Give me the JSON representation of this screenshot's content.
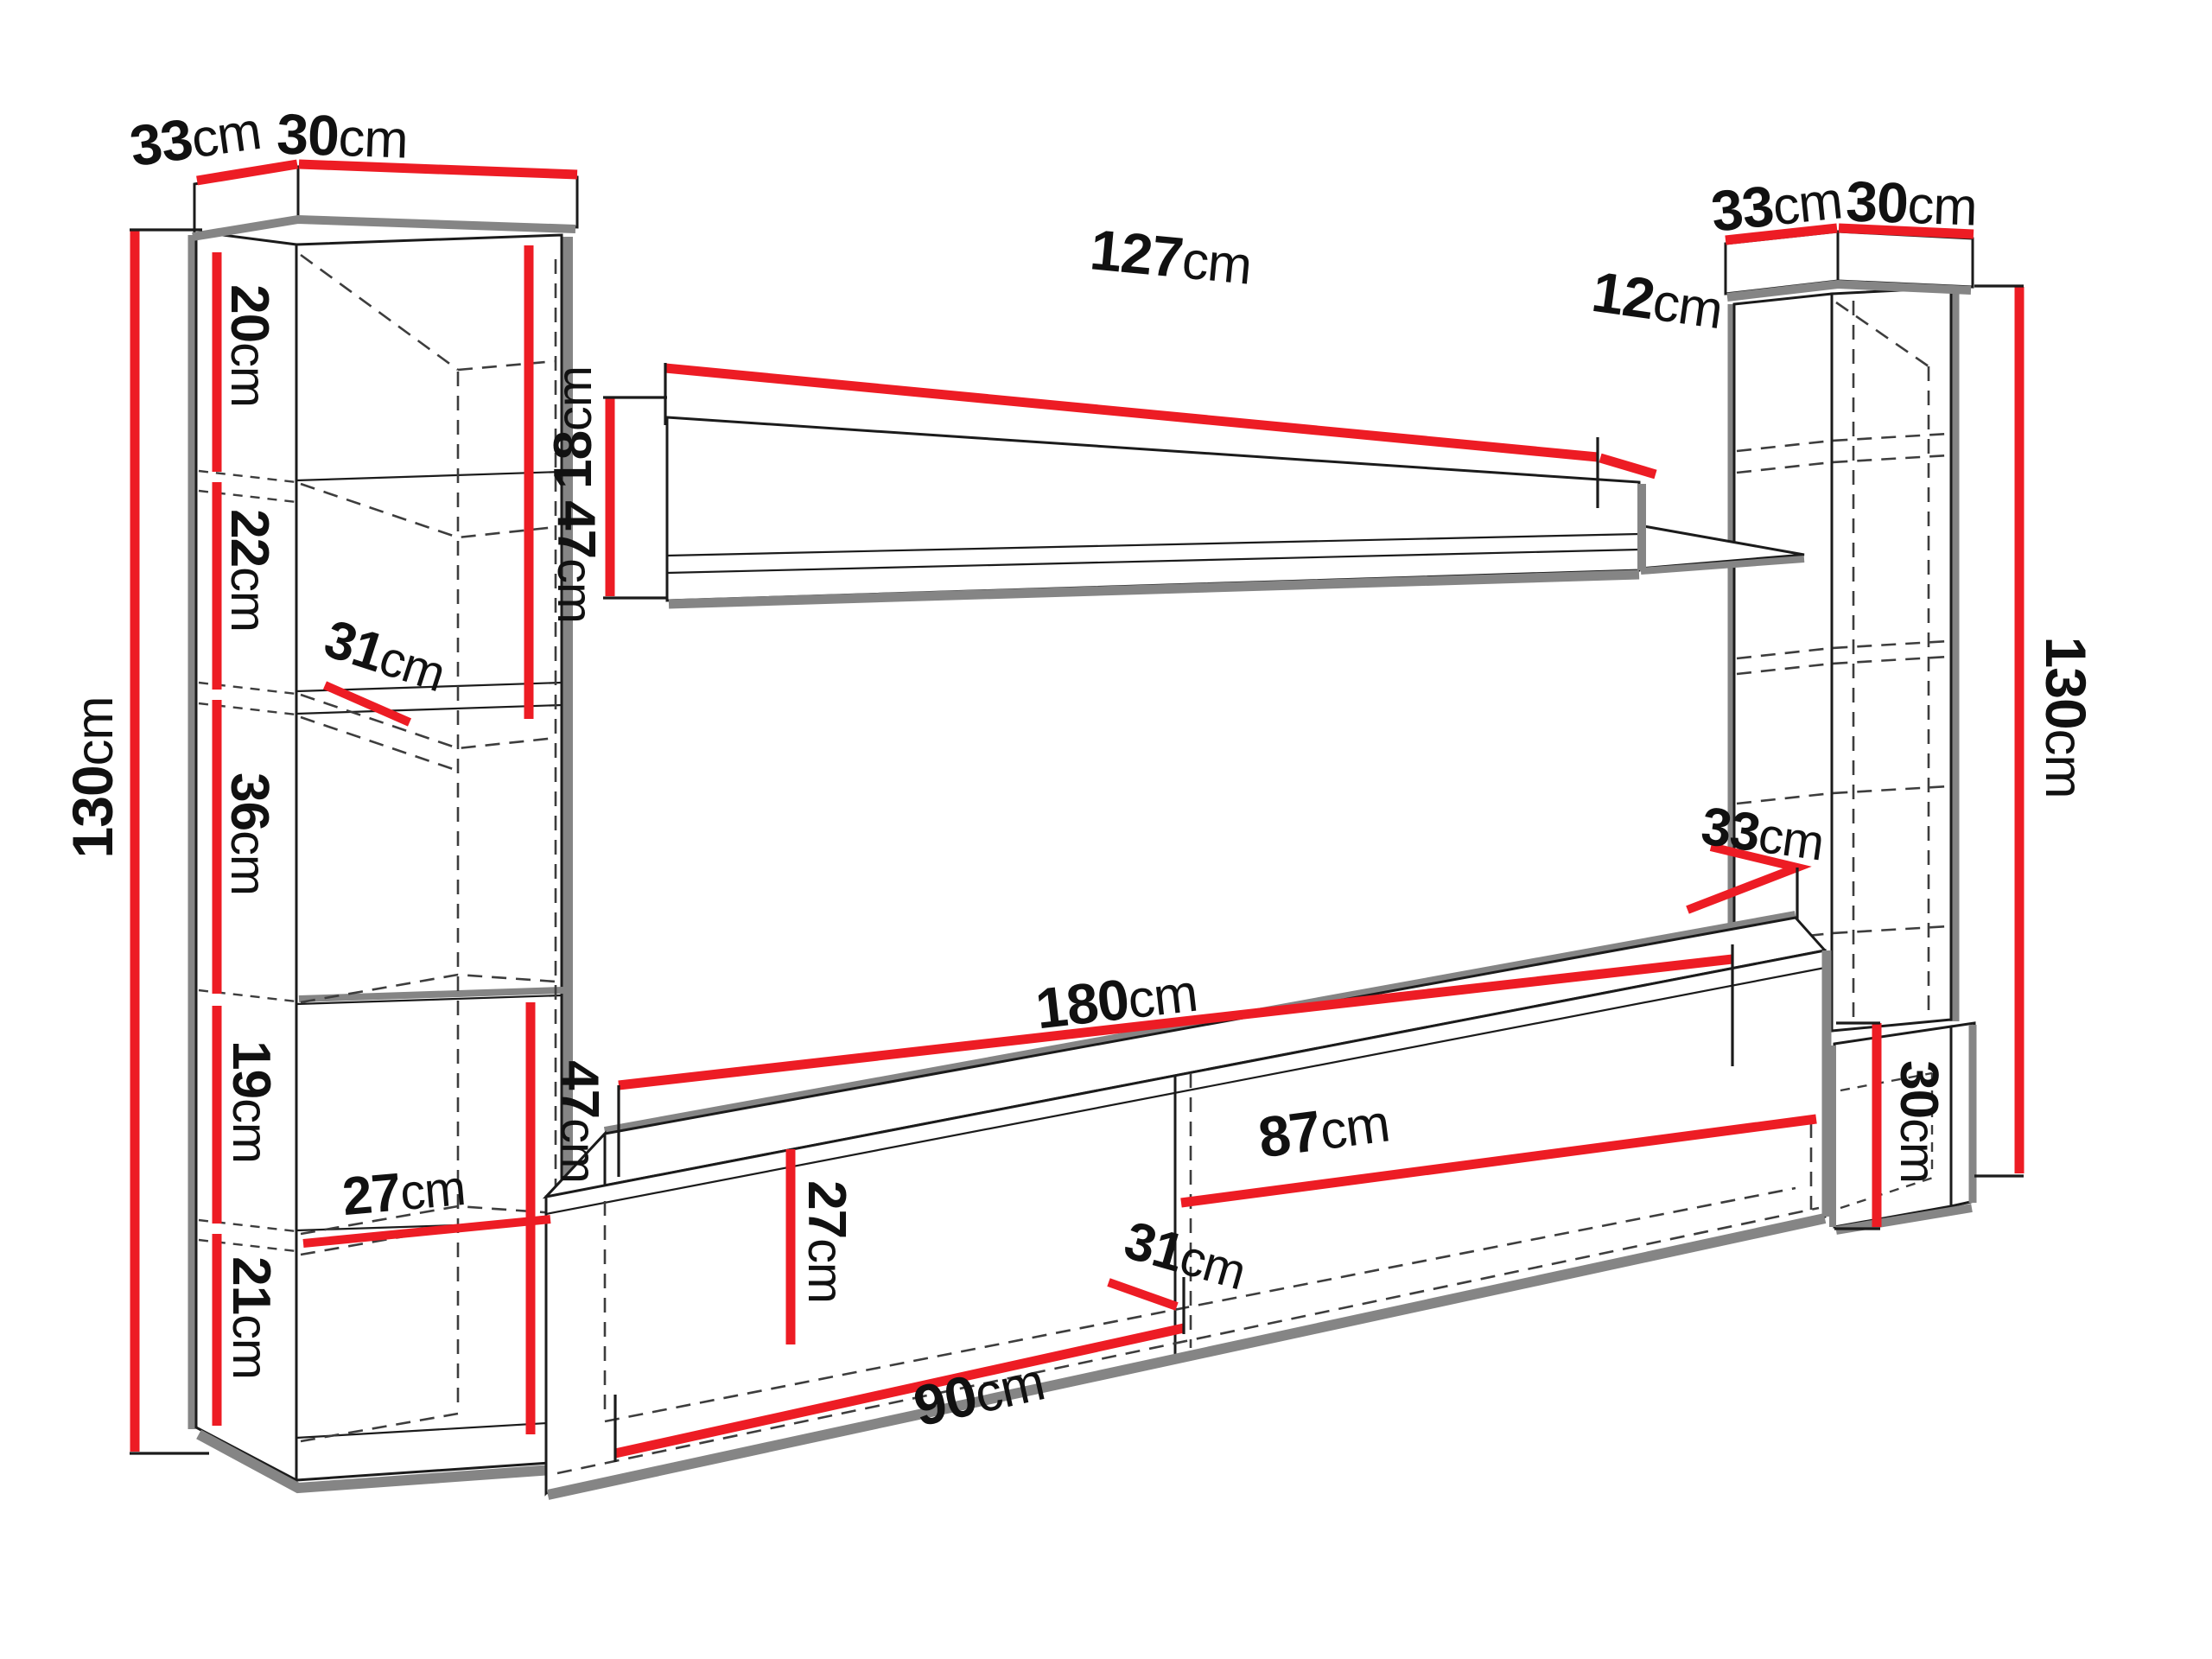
{
  "title": "Wall unit furniture dimension diagram",
  "colors": {
    "dimension_red": "#ed1c24",
    "outline": "#1b1b1b",
    "shadow": "#858585",
    "background": "#ffffff"
  },
  "left_cabinet": {
    "top_depth": {
      "value": "33",
      "unit": "cm"
    },
    "top_width": {
      "value": "30",
      "unit": "cm"
    },
    "total_height": {
      "value": "130",
      "unit": "cm"
    },
    "sections": [
      {
        "value": "20",
        "unit": "cm"
      },
      {
        "value": "22",
        "unit": "cm"
      },
      {
        "value": "36",
        "unit": "cm"
      },
      {
        "value": "19",
        "unit": "cm"
      },
      {
        "value": "21",
        "unit": "cm"
      }
    ],
    "upper_shelf_depth": {
      "value": "31",
      "unit": "cm"
    },
    "lower_shelf_depth": {
      "value": "27",
      "unit": "cm"
    },
    "upper_unit_height": {
      "value": "47",
      "unit": "cm"
    },
    "lower_unit_height": {
      "value": "47",
      "unit": "cm"
    }
  },
  "wall_shelf": {
    "length": {
      "value": "127",
      "unit": "cm"
    },
    "end_depth": {
      "value": "12",
      "unit": "cm"
    },
    "height": {
      "value": "18",
      "unit": "cm"
    }
  },
  "right_cabinet": {
    "top_depth": {
      "value": "33",
      "unit": "cm"
    },
    "top_width": {
      "value": "30",
      "unit": "cm"
    },
    "total_height": {
      "value": "130",
      "unit": "cm"
    },
    "base_height": {
      "value": "30",
      "unit": "cm"
    },
    "depth_at_tv_stand": {
      "value": "33",
      "unit": "cm"
    }
  },
  "tv_stand": {
    "length": {
      "value": "180",
      "unit": "cm"
    },
    "right_section_width": {
      "value": "87",
      "unit": "cm"
    },
    "inner_height": {
      "value": "27",
      "unit": "cm"
    },
    "inner_depth": {
      "value": "31",
      "unit": "cm"
    },
    "left_section_width": {
      "value": "90",
      "unit": "cm"
    }
  }
}
